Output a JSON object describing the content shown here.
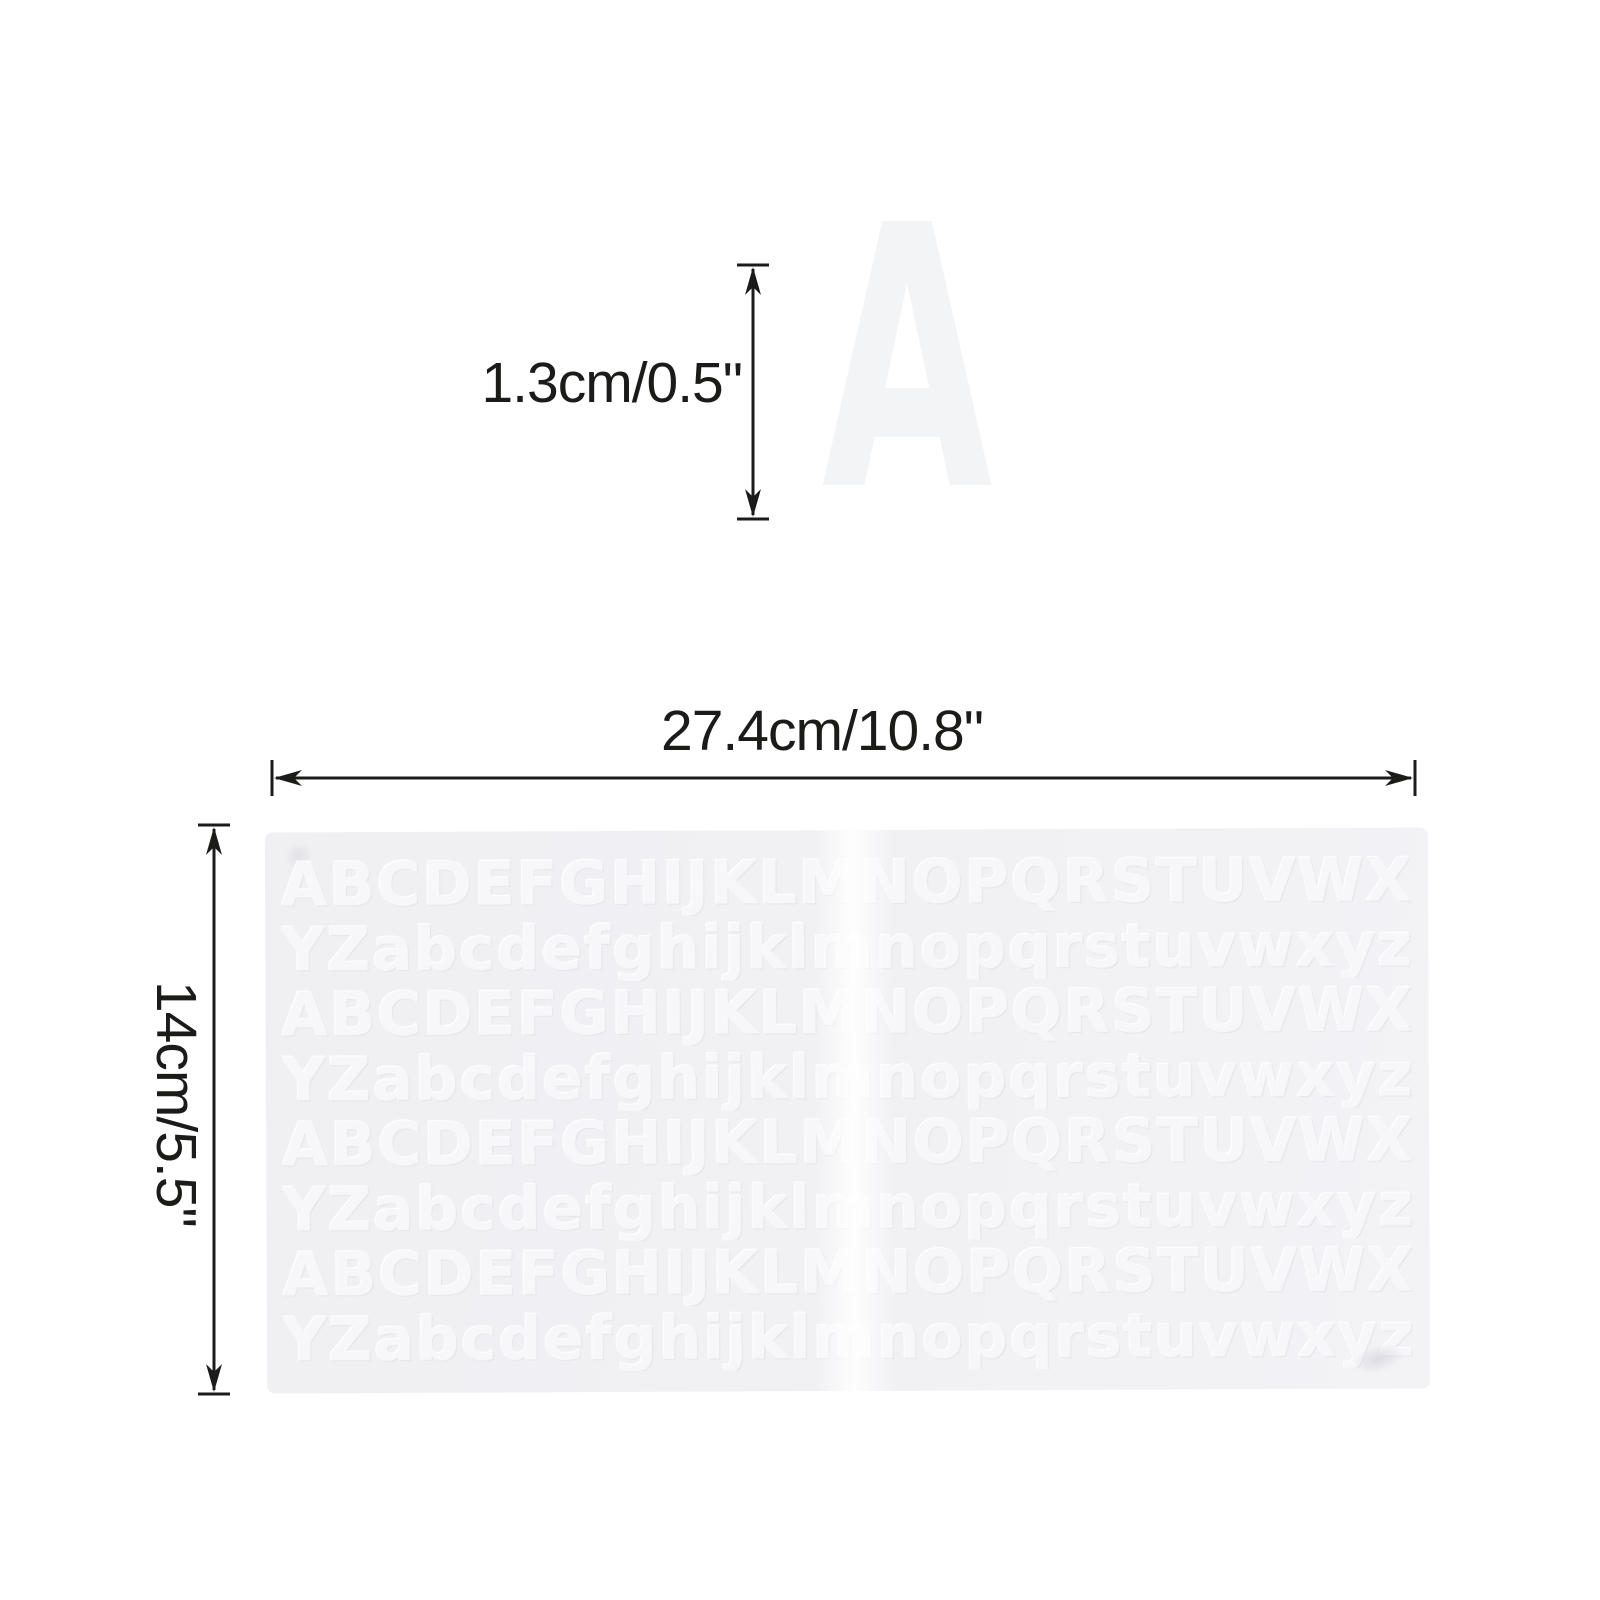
{
  "page": {
    "background_color": "#ffffff",
    "dimension_color": "#1b1b19"
  },
  "sample": {
    "letter": "A",
    "letter_color": "#f3f4f6",
    "height_label": "1.3cm/0.5\""
  },
  "sheet": {
    "width_label": "27.4cm/10.8\"",
    "height_label": "14cm/5.5\"",
    "background_color": "#f1f1f4",
    "letter_color": "#f7f7fa",
    "rows": [
      {
        "letters": "ABCDEFGHIJKLMNOPQRSTUVWX"
      },
      {
        "letters": "YZabcdefghijklmnopqrstuvwxyz"
      },
      {
        "letters": "ABCDEFGHIJKLMNOPQRSTUVWX"
      },
      {
        "letters": "YZabcdefghijklmnopqrstuvwxyz"
      },
      {
        "letters": "ABCDEFGHIJKLMNOPQRSTUVWX"
      },
      {
        "letters": "YZabcdefghijklmnopqrstuvwxyz"
      },
      {
        "letters": "ABCDEFGHIJKLMNOPQRSTUVWX"
      },
      {
        "letters": "YZabcdefghijklmnopqrstuvwxyz"
      }
    ]
  }
}
